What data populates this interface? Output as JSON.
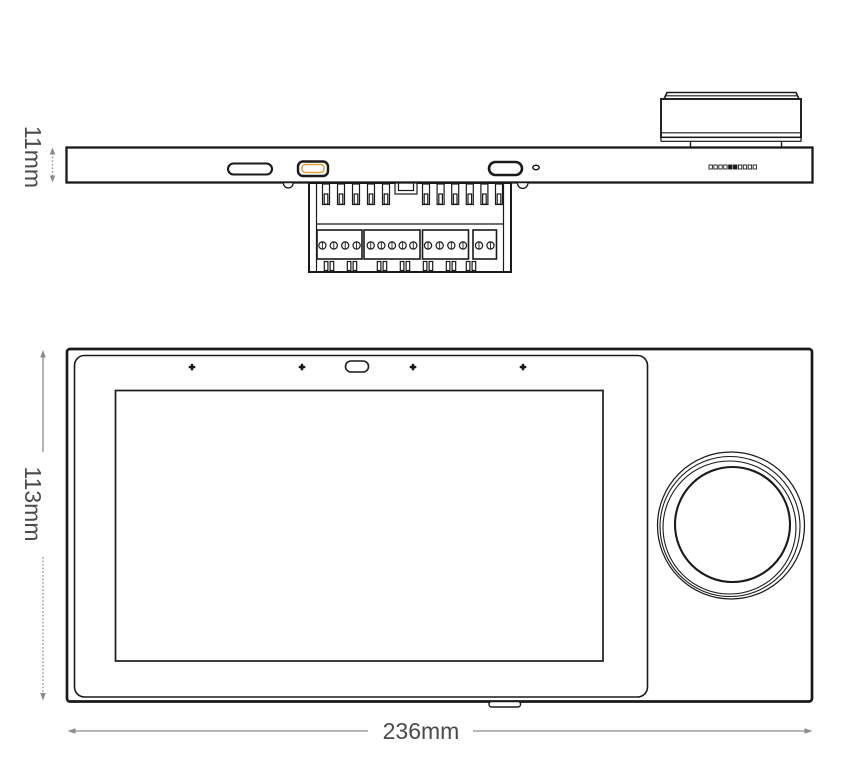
{
  "page": {
    "background": "#ffffff"
  },
  "drawing": {
    "line_color": "#1a1a1a",
    "dimension_color": "#8c8c8c",
    "text_color": "#4a4a4a",
    "accent_color": "#dfa13c"
  },
  "dimensions": {
    "thickness": "11mm",
    "height": "113mm",
    "width": "236mm"
  },
  "side_view": {
    "pin_count": 10,
    "teeth_left": 5,
    "teeth_right": 6,
    "terminal_blocks": [
      4,
      5,
      4,
      2
    ],
    "tab_pair_count": 7
  },
  "front_view": {
    "sensor_dots": 4
  }
}
